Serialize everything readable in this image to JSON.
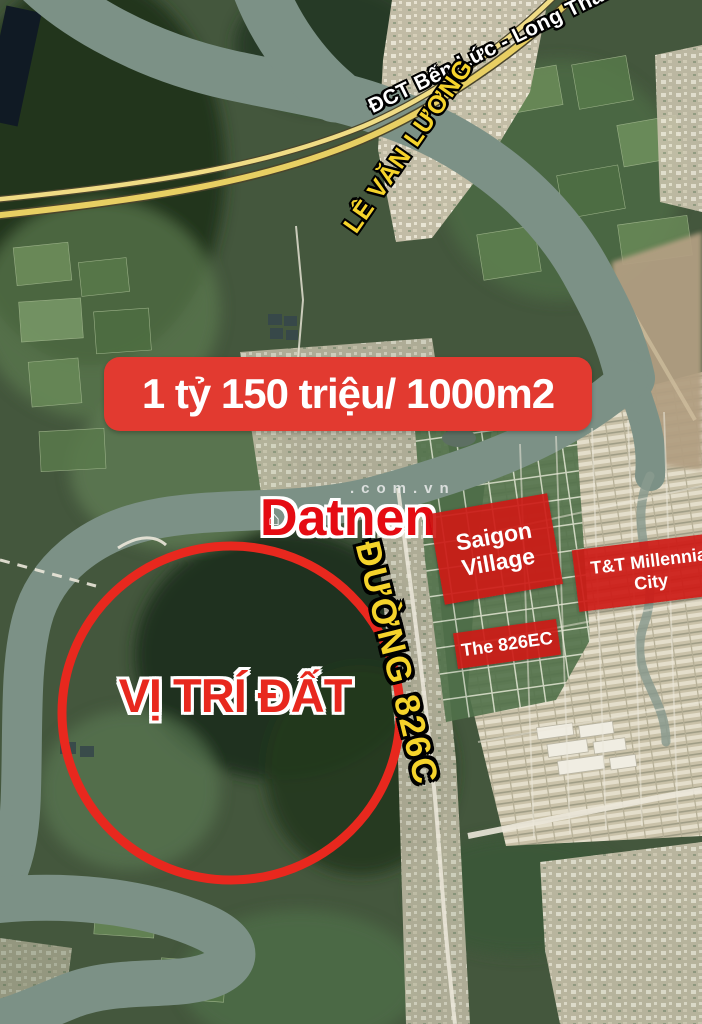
{
  "map": {
    "road_labels": {
      "expressway": "ĐCT Bến Lức - Long Thành",
      "street": "LÊ VĂN LƯƠNG",
      "road_826c": "ĐƯỜNG 826C"
    },
    "place_labels": {
      "saigon_village": "Saigon Village",
      "tt_millennia": "T&T Millennia City",
      "the_826ec": "The 826EC"
    }
  },
  "listing": {
    "price_banner": "1 tỷ 150 triệu/ 1000m2",
    "location_label": "VỊ TRÍ ĐẤT"
  },
  "branding": {
    "logo": "Datnen",
    "watermark": ".com.vn",
    "house_glyph": "⌂"
  },
  "colors": {
    "banner_red": "#e23a30",
    "label_box_red": "#cd1a16",
    "accent_red": "#e8281e",
    "road_text_yellow": "#f5d32b",
    "logo_red": "#e50b12",
    "river_gray_green": "#7c9186",
    "expressway_yellow": "#e8cf63"
  }
}
